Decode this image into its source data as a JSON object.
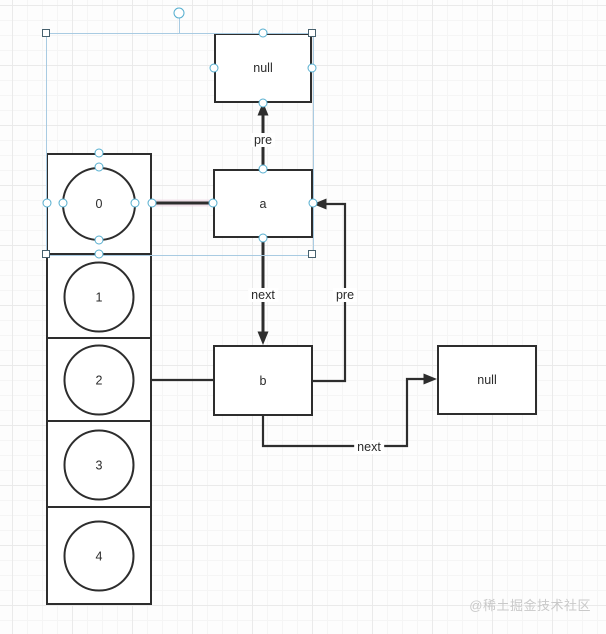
{
  "diagram": {
    "nodes": {
      "null_top": {
        "label": "null"
      },
      "a": {
        "label": "a"
      },
      "b": {
        "label": "b"
      },
      "null_right": {
        "label": "null"
      }
    },
    "array": {
      "cells": [
        "0",
        "1",
        "2",
        "3",
        "4"
      ]
    },
    "edge_labels": {
      "pre_a_null": "pre",
      "next_a_b": "next",
      "pre_b_a": "pre",
      "next_b_null": "next"
    }
  },
  "colors": {
    "shape_stroke": "#2d2d2d",
    "selection_handle": "#55aecf",
    "selection_box": "#a9cbe2",
    "corner_handle": "#47616e",
    "background": "#fdfdfd",
    "watermark": "#c9c9c9"
  },
  "watermark": {
    "text": "@稀土掘金技术社区"
  }
}
